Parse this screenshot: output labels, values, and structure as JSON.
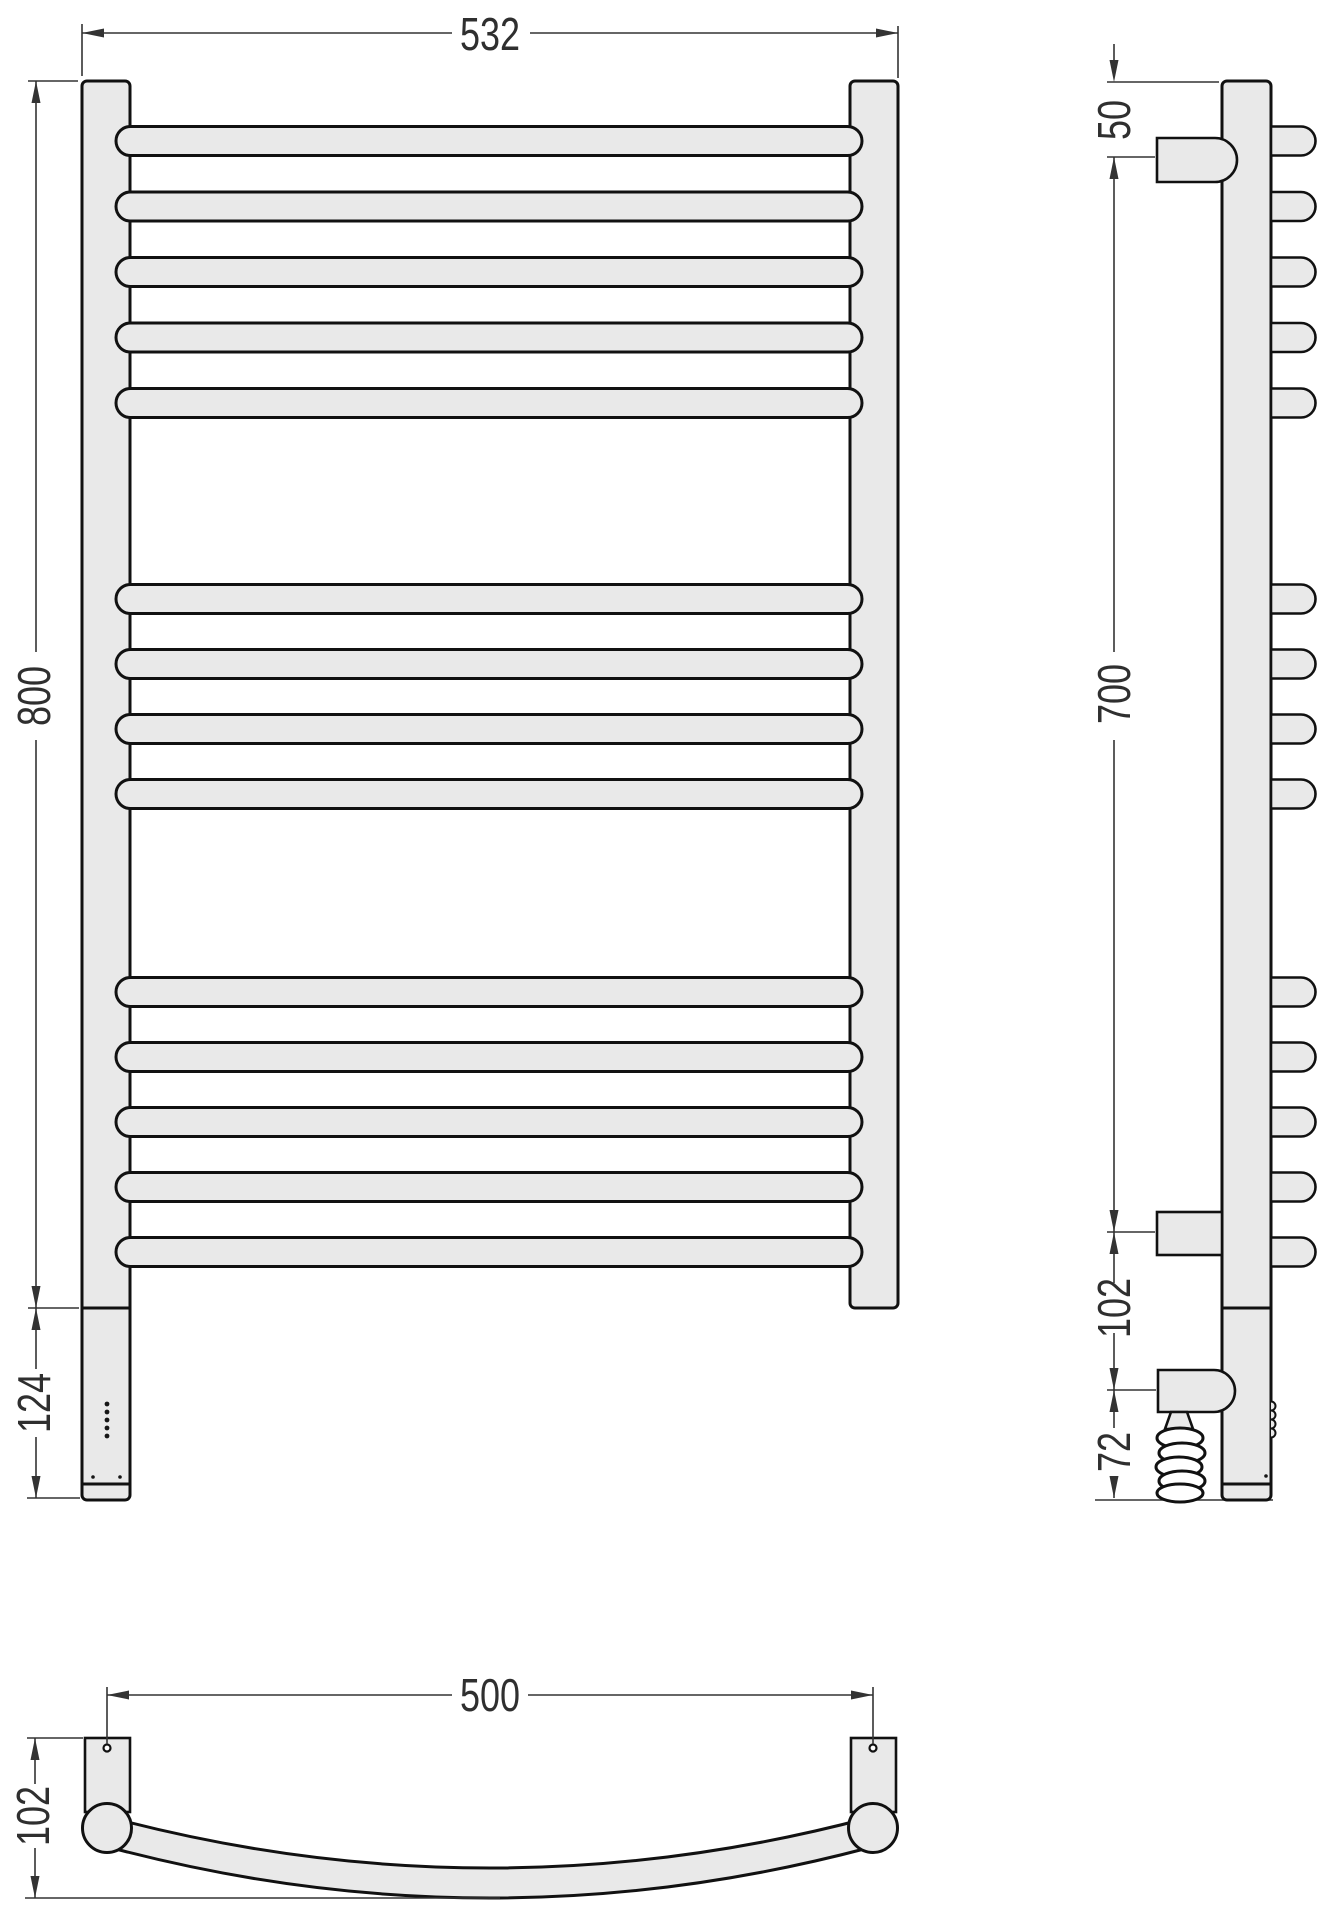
{
  "drawing": {
    "type": "technical-drawing",
    "subject": "wall-mounted curved ladder towel rail, three orthographic views",
    "colors": {
      "outline": "#111111",
      "fill": "#e9e9e9",
      "dimension": "#333333",
      "background": "#ffffff"
    },
    "views": {
      "front": {
        "label": "front-view",
        "rail_groups": [
          5,
          4,
          5
        ],
        "dimensions": {
          "overall_width": "532",
          "overall_height": "800",
          "lower_section_height": "124"
        }
      },
      "side": {
        "label": "side-view",
        "dimensions": {
          "top_to_upper_bracket": "50",
          "bracket_span": "700",
          "bracket_to_heater": "102",
          "heater_to_bottom": "72"
        }
      },
      "top": {
        "label": "top-view",
        "dimensions": {
          "mount_spacing": "500",
          "depth": "102"
        }
      }
    }
  }
}
